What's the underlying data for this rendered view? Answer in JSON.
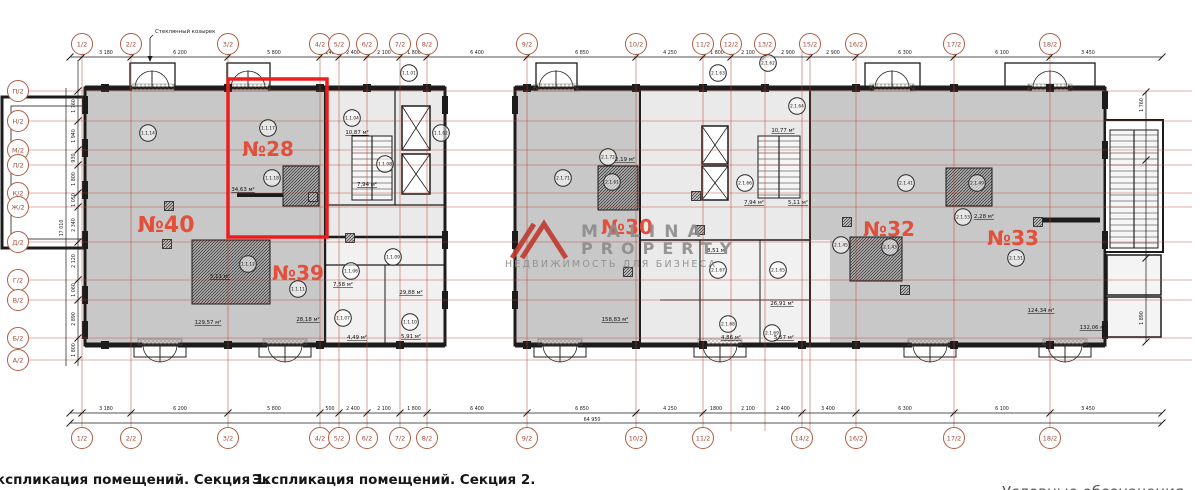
{
  "titles": {
    "section1": "Экспликация помещений. Секция 1.",
    "section2": "Экспликация помещений. Секция 2.",
    "legend": "Условные обозначения"
  },
  "annotations": {
    "canopy": "Стеклянный козырек",
    "total_width": "64 950",
    "total_height": "17 010"
  },
  "watermark": {
    "brand_line1": "MALINA",
    "brand_line2": "PROPERTY",
    "tagline": "НЕДВИЖИМОСТЬ ДЛЯ БИЗНЕСА"
  },
  "colors": {
    "highlight": "#ee1d1d",
    "axis_bubble": "#b05c42",
    "grid_line": "#b64434",
    "room_number": "#e2503c",
    "wall": "#1c1c1c",
    "fill_main": "#c8c8c8",
    "fill_core": "#eaeaea",
    "watermark_gray": "#8c8c8c",
    "logo_red": "#bf3a2e"
  },
  "axes": {
    "top": [
      {
        "label": "1/2",
        "x": 82
      },
      {
        "label": "2/2",
        "x": 131
      },
      {
        "label": "3/2",
        "x": 228
      },
      {
        "label": "4/2",
        "x": 320
      },
      {
        "label": "5/2",
        "x": 339
      },
      {
        "label": "6/2",
        "x": 367
      },
      {
        "label": "7/2",
        "x": 400
      },
      {
        "label": "8/2",
        "x": 427
      },
      {
        "label": "9/2",
        "x": 527
      },
      {
        "label": "10/2",
        "x": 636
      },
      {
        "label": "11/2",
        "x": 703
      },
      {
        "label": "12/2",
        "x": 731
      },
      {
        "label": "13/2",
        "x": 765
      },
      {
        "label": "15/2",
        "x": 810
      },
      {
        "label": "16/2",
        "x": 856
      },
      {
        "label": "17/2",
        "x": 954
      },
      {
        "label": "18/2",
        "x": 1050
      }
    ],
    "bottom": [
      {
        "label": "1/2",
        "x": 82
      },
      {
        "label": "2/2",
        "x": 131
      },
      {
        "label": "3/2",
        "x": 228
      },
      {
        "label": "4/2",
        "x": 320
      },
      {
        "label": "5/2",
        "x": 339
      },
      {
        "label": "6/2",
        "x": 367
      },
      {
        "label": "7/2",
        "x": 400
      },
      {
        "label": "8/2",
        "x": 427
      },
      {
        "label": "9/2",
        "x": 527
      },
      {
        "label": "10/2",
        "x": 636
      },
      {
        "label": "11/2",
        "x": 703
      },
      {
        "label": "14/2",
        "x": 802
      },
      {
        "label": "16/2",
        "x": 856
      },
      {
        "label": "17/2",
        "x": 954
      },
      {
        "label": "18/2",
        "x": 1050
      }
    ],
    "left": [
      {
        "label": "П/2",
        "y": 91
      },
      {
        "label": "Н/2",
        "y": 121
      },
      {
        "label": "М/2",
        "y": 150
      },
      {
        "label": "Л/2",
        "y": 165
      },
      {
        "label": "К/2",
        "y": 193
      },
      {
        "label": "Ж/2",
        "y": 207
      },
      {
        "label": "Д/2",
        "y": 242
      },
      {
        "label": "Г/2",
        "y": 280
      },
      {
        "label": "В/2",
        "y": 300
      },
      {
        "label": "Б/2",
        "y": 338
      },
      {
        "label": "А/2",
        "y": 360
      }
    ]
  },
  "dimensions": {
    "top": [
      {
        "text": "3 180",
        "x": 106
      },
      {
        "text": "6 200",
        "x": 180
      },
      {
        "text": "5 800",
        "x": 274
      },
      {
        "text": "240",
        "x": 330
      },
      {
        "text": "2 400",
        "x": 353
      },
      {
        "text": "2 100",
        "x": 384
      },
      {
        "text": "1 800",
        "x": 414
      },
      {
        "text": "6 400",
        "x": 477
      },
      {
        "text": "6 850",
        "x": 582
      },
      {
        "text": "4 250",
        "x": 670
      },
      {
        "text": "1 800",
        "x": 717
      },
      {
        "text": "2 100",
        "x": 748
      },
      {
        "text": "2 900",
        "x": 788
      },
      {
        "text": "2 900",
        "x": 833
      },
      {
        "text": "6 300",
        "x": 905
      },
      {
        "text": "6 100",
        "x": 1002
      },
      {
        "text": "3 450",
        "x": 1088
      }
    ],
    "bottom": [
      {
        "text": "3 180",
        "x": 106
      },
      {
        "text": "6 200",
        "x": 180
      },
      {
        "text": "5 800",
        "x": 274
      },
      {
        "text": "500",
        "x": 330
      },
      {
        "text": "2 400",
        "x": 353
      },
      {
        "text": "2 100",
        "x": 384
      },
      {
        "text": "1 800",
        "x": 414
      },
      {
        "text": "6 400",
        "x": 477
      },
      {
        "text": "6 850",
        "x": 582
      },
      {
        "text": "4 250",
        "x": 670
      },
      {
        "text": "1800",
        "x": 716
      },
      {
        "text": "2 100",
        "x": 748
      },
      {
        "text": "2 400",
        "x": 783
      },
      {
        "text": "3 400",
        "x": 828
      },
      {
        "text": "6 300",
        "x": 905
      },
      {
        "text": "6 100",
        "x": 1002
      },
      {
        "text": "3 450",
        "x": 1088
      }
    ],
    "left": [
      {
        "text": "1 760",
        "y": 106
      },
      {
        "text": "1 940",
        "y": 136
      },
      {
        "text": "930",
        "y": 158
      },
      {
        "text": "1 800",
        "y": 179
      },
      {
        "text": "1 050",
        "y": 200
      },
      {
        "text": "2 340",
        "y": 225
      },
      {
        "text": "2 120",
        "y": 261
      },
      {
        "text": "1 060",
        "y": 290
      },
      {
        "text": "2 890",
        "y": 319
      },
      {
        "text": "1 800",
        "y": 350
      }
    ],
    "right": [
      {
        "text": "1 760",
        "y": 105
      },
      {
        "text": "1 890",
        "y": 318
      }
    ]
  },
  "rooms": [
    {
      "number": "№40",
      "x": 166,
      "y": 232,
      "size": 22
    },
    {
      "number": "№28",
      "x": 268,
      "y": 156,
      "size": 20
    },
    {
      "number": "№39",
      "x": 298,
      "y": 280,
      "size": 20
    },
    {
      "number": "№30",
      "x": 627,
      "y": 234,
      "size": 20
    },
    {
      "number": "№32",
      "x": 889,
      "y": 236,
      "size": 20
    },
    {
      "number": "№33",
      "x": 1013,
      "y": 245,
      "size": 20
    }
  ],
  "area_labels": [
    {
      "text": "129,57 м²",
      "x": 208,
      "y": 324
    },
    {
      "text": "34,63 м²",
      "x": 243,
      "y": 191
    },
    {
      "text": "28,18 м²",
      "x": 308,
      "y": 321
    },
    {
      "text": "5,11 м²",
      "x": 220,
      "y": 278
    },
    {
      "text": "10,87 м²",
      "x": 357,
      "y": 134
    },
    {
      "text": "7,94 м²",
      "x": 367,
      "y": 186
    },
    {
      "text": "7,58 м²",
      "x": 343,
      "y": 286
    },
    {
      "text": "29,88 м²",
      "x": 411,
      "y": 294
    },
    {
      "text": "4,49 м²",
      "x": 357,
      "y": 339
    },
    {
      "text": "5,91 м²",
      "x": 411,
      "y": 338
    },
    {
      "text": "2,19 м²",
      "x": 625,
      "y": 161
    },
    {
      "text": "10,77 м²",
      "x": 783,
      "y": 132
    },
    {
      "text": "7,94 м²",
      "x": 754,
      "y": 204
    },
    {
      "text": "5,11 м²",
      "x": 798,
      "y": 204
    },
    {
      "text": "8,51 м²",
      "x": 717,
      "y": 252
    },
    {
      "text": "26,91 м²",
      "x": 782,
      "y": 305
    },
    {
      "text": "4,86 м²",
      "x": 731,
      "y": 339
    },
    {
      "text": "5,57 м²",
      "x": 784,
      "y": 339
    },
    {
      "text": "2,28 м²",
      "x": 984,
      "y": 218
    },
    {
      "text": "158,83 м²",
      "x": 615,
      "y": 321
    },
    {
      "text": "124,34 м²",
      "x": 1041,
      "y": 312
    },
    {
      "text": "132,06 м²",
      "x": 1093,
      "y": 329
    }
  ],
  "unit_circles": [
    {
      "code": "1.1.14",
      "x": 148,
      "y": 133
    },
    {
      "code": "1.1.17",
      "x": 268,
      "y": 128
    },
    {
      "code": "1.1.18",
      "x": 272,
      "y": 178
    },
    {
      "code": "1.1.12",
      "x": 248,
      "y": 264
    },
    {
      "code": "1.1.11",
      "x": 298,
      "y": 289
    },
    {
      "code": "1.1.01",
      "x": 409,
      "y": 73
    },
    {
      "code": "1.1.02",
      "x": 441,
      "y": 133
    },
    {
      "code": "1.1.04",
      "x": 352,
      "y": 118
    },
    {
      "code": "1.1.08",
      "x": 385,
      "y": 164
    },
    {
      "code": "1.1.06",
      "x": 351,
      "y": 271
    },
    {
      "code": "1.1.09",
      "x": 393,
      "y": 257
    },
    {
      "code": "1.1.07",
      "x": 343,
      "y": 318
    },
    {
      "code": "1.1.10",
      "x": 410,
      "y": 322
    },
    {
      "code": "2.1.71",
      "x": 563,
      "y": 178
    },
    {
      "code": "2.1.72",
      "x": 608,
      "y": 157
    },
    {
      "code": "2.1.61",
      "x": 612,
      "y": 182
    },
    {
      "code": "2.1.63",
      "x": 718,
      "y": 73
    },
    {
      "code": "2.1.62",
      "x": 768,
      "y": 63
    },
    {
      "code": "2.1.64",
      "x": 797,
      "y": 106
    },
    {
      "code": "2.1.66",
      "x": 745,
      "y": 183
    },
    {
      "code": "2.1.67",
      "x": 718,
      "y": 270
    },
    {
      "code": "2.1.65",
      "x": 778,
      "y": 270
    },
    {
      "code": "2.1.68",
      "x": 728,
      "y": 324
    },
    {
      "code": "2.1.69",
      "x": 772,
      "y": 333
    },
    {
      "code": "2.1.41",
      "x": 906,
      "y": 183
    },
    {
      "code": "2.1.45",
      "x": 841,
      "y": 245
    },
    {
      "code": "2.1.43",
      "x": 890,
      "y": 247
    },
    {
      "code": "2.1.49",
      "x": 977,
      "y": 183
    },
    {
      "code": "2.1.53",
      "x": 963,
      "y": 217
    },
    {
      "code": "2.1.51",
      "x": 1016,
      "y": 258
    }
  ]
}
